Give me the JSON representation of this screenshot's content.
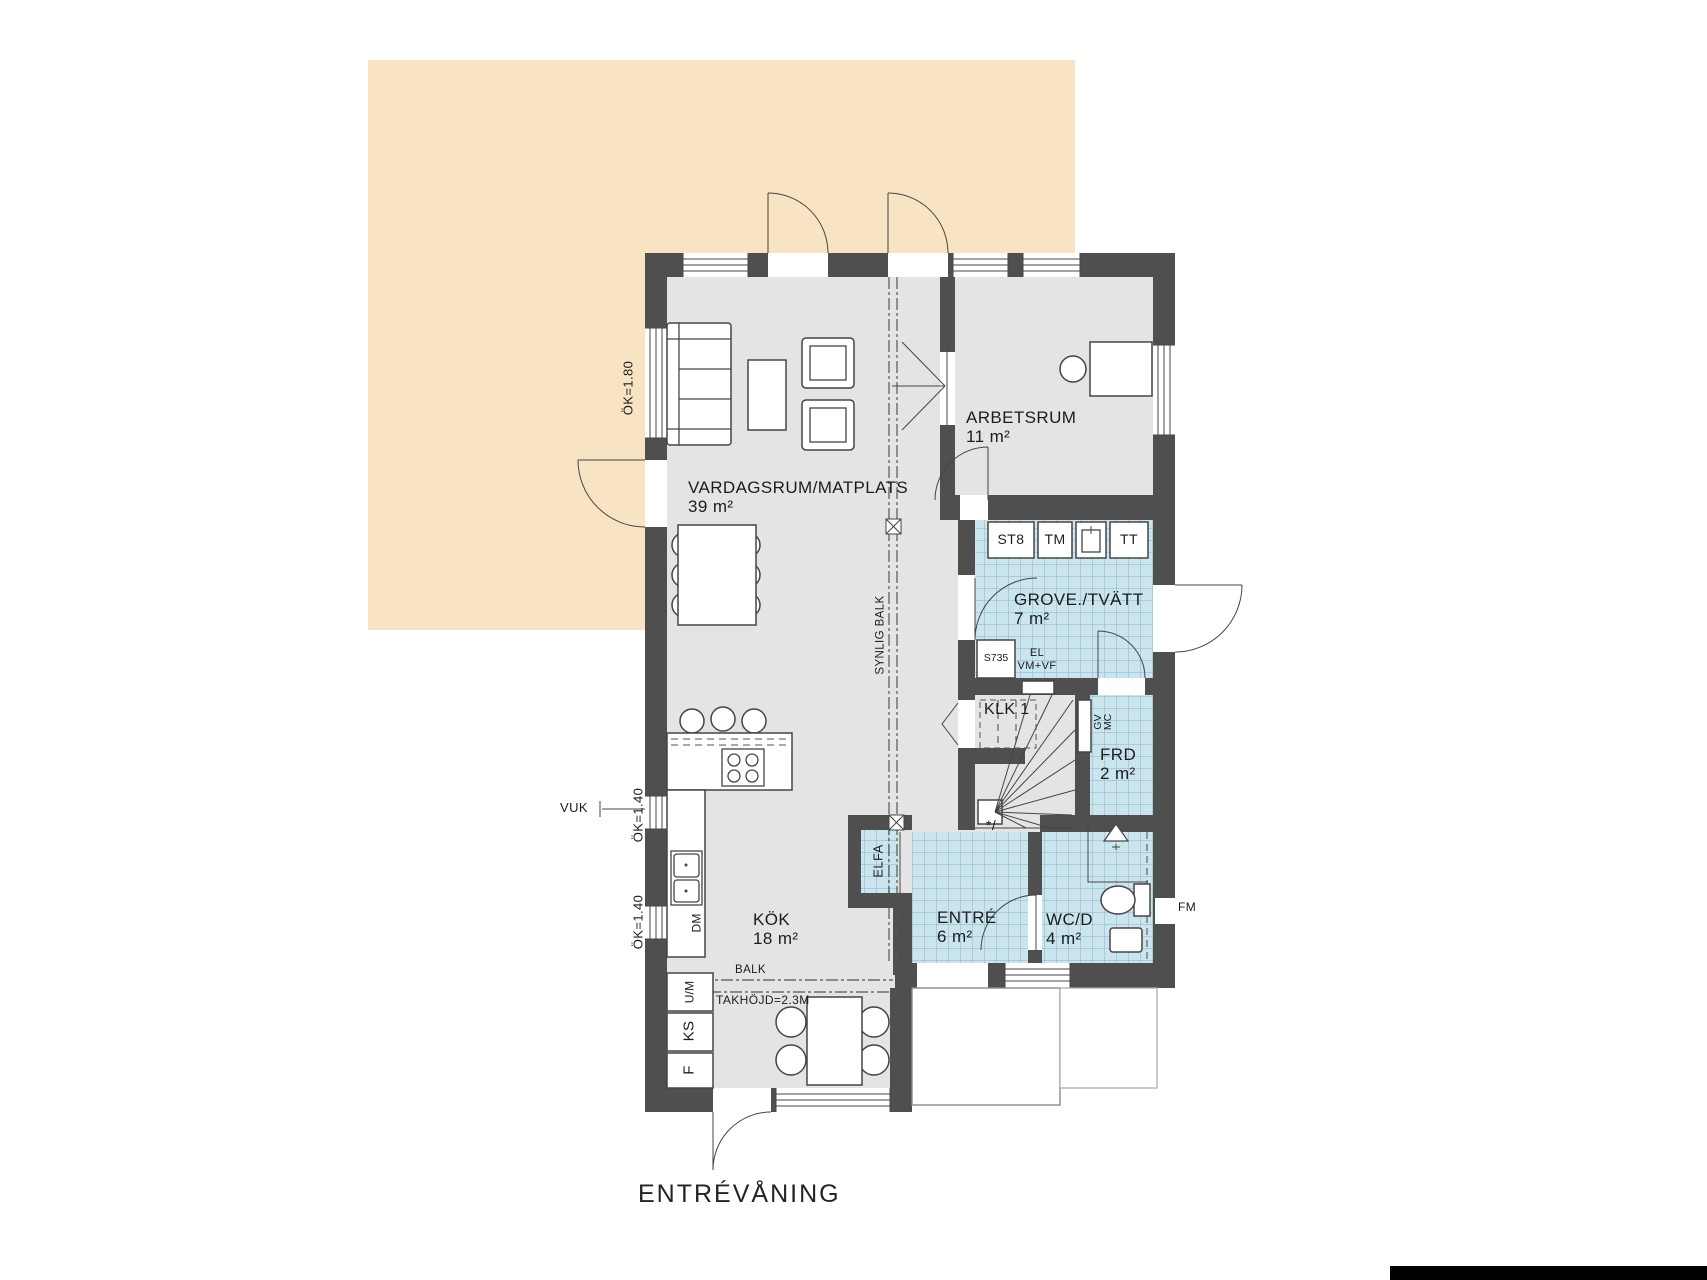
{
  "title": "ENTRÉVÅNING",
  "colors": {
    "terrace": "#f8e4c3",
    "floor": "#e4e4e4",
    "wall": "#4f4f4f",
    "tile": "#cbe5ef",
    "tile_line": "#8ab3c2",
    "ink": "#454545",
    "text": "#1c1c1c"
  },
  "rooms": {
    "vardagsrum": {
      "name": "VARDAGSRUM/MATPLATS",
      "area": "39 m²"
    },
    "arbetsrum": {
      "name": "ARBETSRUM",
      "area": "11 m²"
    },
    "grovtvatt": {
      "name": "GROVE./TVÄTT",
      "area": "7 m²"
    },
    "klk": {
      "name": "KLK 1"
    },
    "frd": {
      "name": "FRD",
      "area": "2 m²"
    },
    "entre": {
      "name": "ENTRÉ",
      "area": "6 m²"
    },
    "wcd": {
      "name": "WC/D",
      "area": "4 m²"
    },
    "kok": {
      "name": "KÖK",
      "area": "18 m²"
    }
  },
  "appliances": {
    "st8": "ST8",
    "tm": "TM",
    "tt": "TT",
    "s735": "S735",
    "dm": "DM",
    "um": "U/M",
    "ks": "KS",
    "f": "F"
  },
  "annotations": {
    "ok180": "ÖK=1.80",
    "ok140_upper": "ÖK=1.40",
    "ok140_lower": "ÖK=1.40",
    "vuk": "VUK",
    "synlig_balk": "SYNLIG BALK",
    "balk": "BALK",
    "takhojd": "TAKHÖJD=2.3M",
    "el": "EL",
    "vmvf": "VM+VF",
    "gv": "GV",
    "mc": "MC",
    "fm": "FM",
    "star": "*/",
    "elfa": "ELFA"
  }
}
